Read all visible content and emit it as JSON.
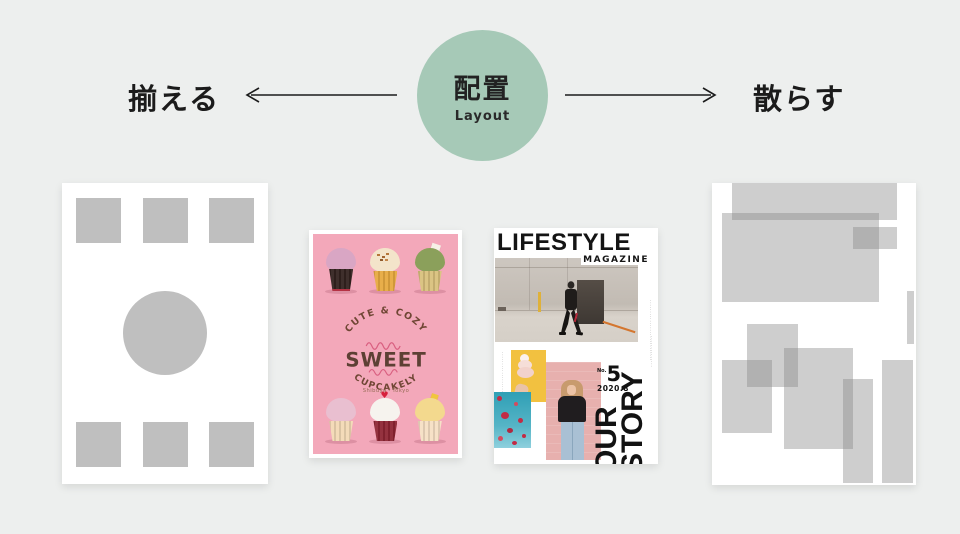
{
  "header": {
    "left_label": "揃える",
    "right_label": "散らす",
    "circle": {
      "title": "配置",
      "subtitle": "Layout",
      "color": "#a6c9b7"
    }
  },
  "posters": {
    "cupcake": {
      "arc_top": "CUTE & COZY",
      "title": "SWEET",
      "arc_bottom": "CUPCAKELY",
      "location": "Shibuya・Tokyo",
      "bg_color": "#f3a8ba",
      "text_color": "#5d4034"
    },
    "magazine": {
      "title": "LIFESTYLE",
      "subtitle": "MAGAZINE",
      "issue_label": "No.",
      "issue_number": "5",
      "issue_date": "2020.8",
      "story_line1": "OUR",
      "story_line2": "STORY",
      "micro_text_right": "···························",
      "micro_text_left": "··················",
      "micro_text_story": "··············"
    }
  },
  "palette": {
    "background": "#edefee",
    "ink": "#1b1b1b",
    "gray_block": "#bfbfbf",
    "magazine_yellow": "#f2c140",
    "magazine_teal": "#3aa0b4",
    "magazine_pink": "#e7b0ae"
  }
}
